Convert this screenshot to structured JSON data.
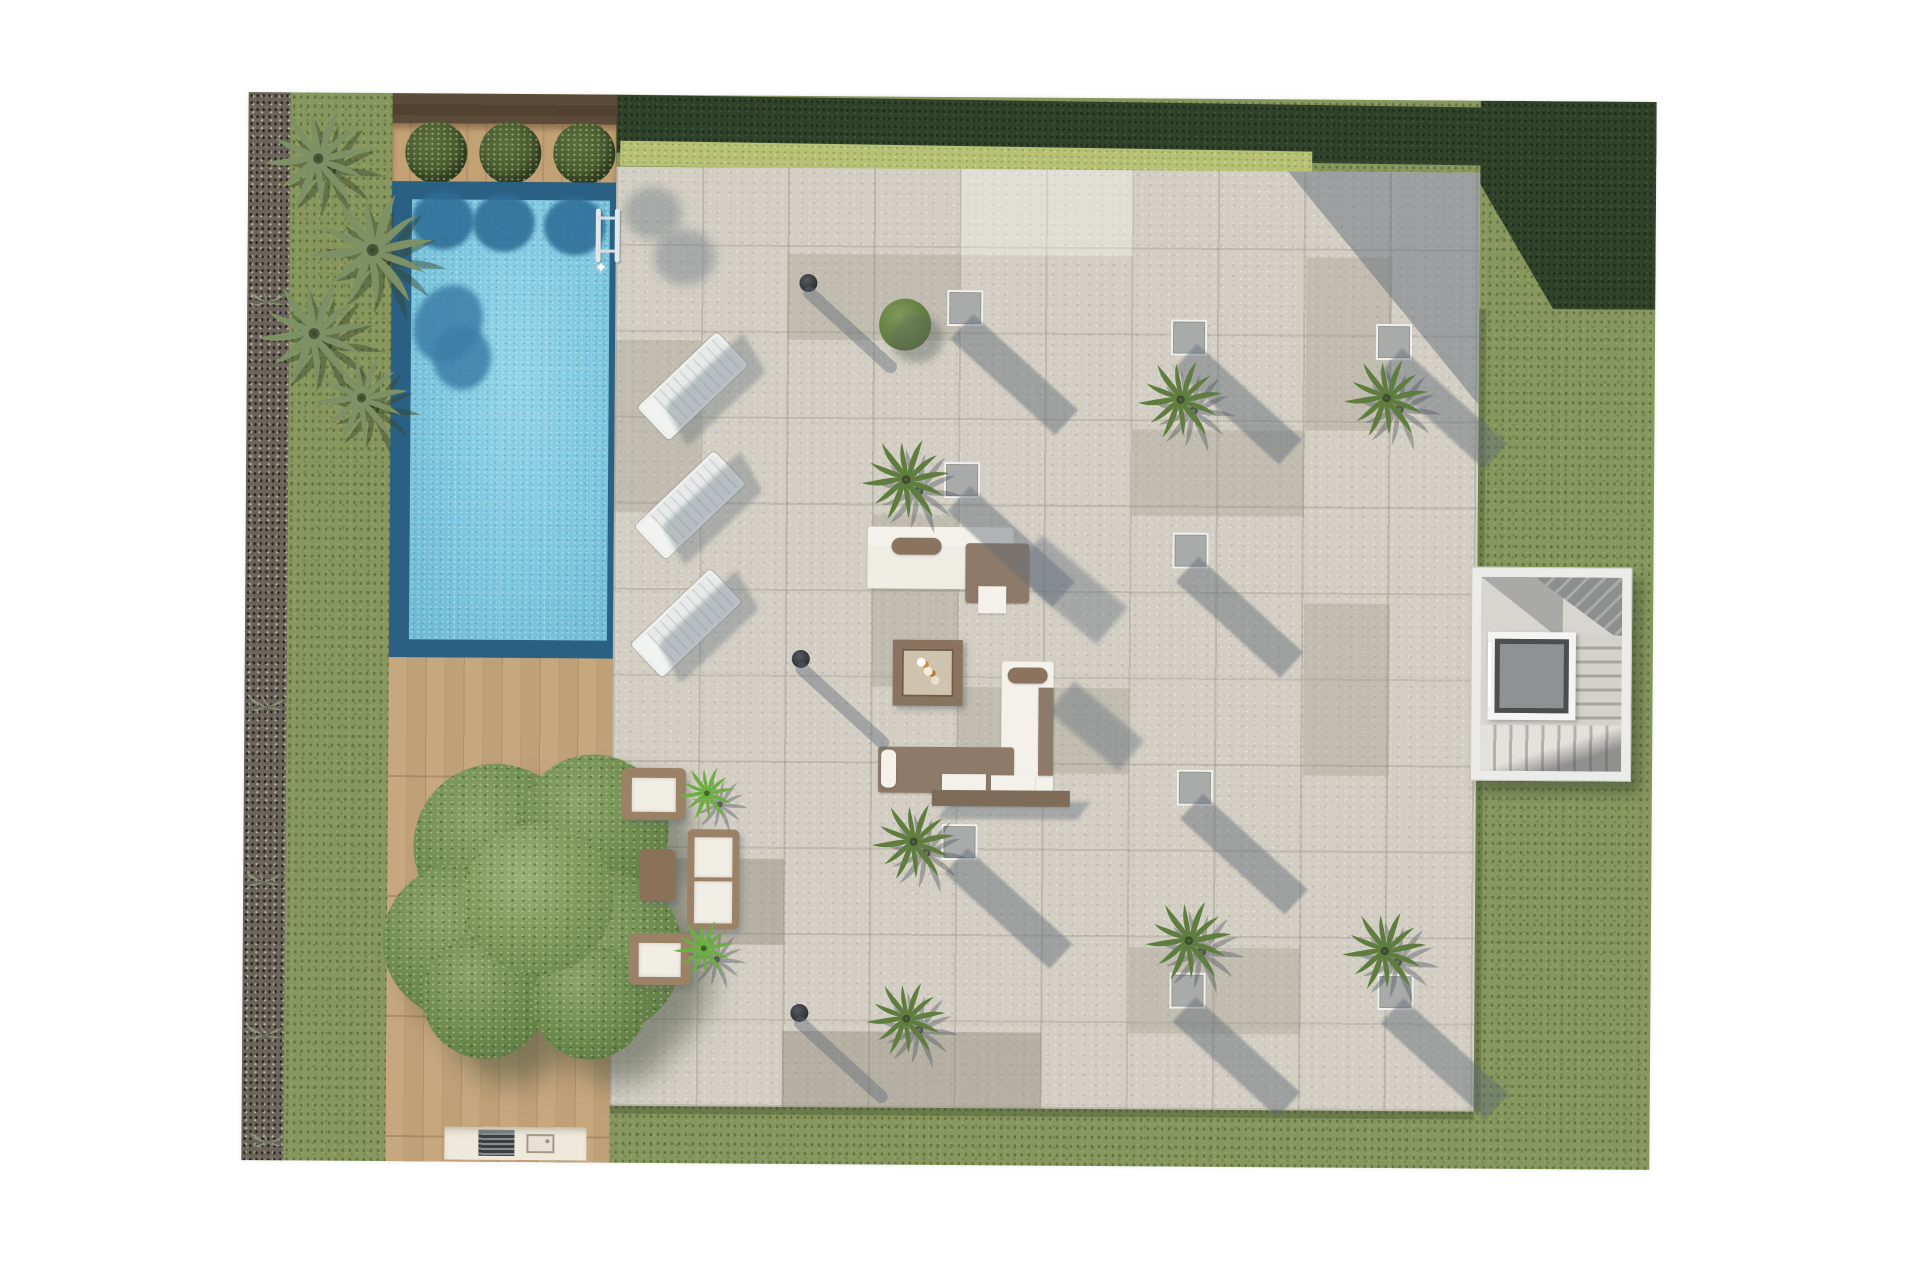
{
  "meta": {
    "title": "Villa roof-garden / pool terrace – top-down architectural render",
    "type": "architectural-site-plan",
    "visible_text": []
  },
  "palette": {
    "background": "#ffffff",
    "grass": "#87975e",
    "hedge_dark": "#31422b",
    "grass_light": "#b6c175",
    "gravel": "#6b655c",
    "pool_border": "#2a6084",
    "pool_water": "#7cc6de",
    "deck_dark_wood": "#5d4b3a",
    "deck_light_wood": "#c2a37b",
    "terrace_tile": "#d2cec3",
    "planter_gray": "#a9abaa",
    "furniture_white": "#f3f1ea",
    "furniture_brown": "#8a7460",
    "tree_green": "#6c8a4c",
    "palm_green": "#5f7d3f",
    "stairs_gray": "#8f9192",
    "shadow": "rgba(100,110,122,0.45)"
  },
  "scene": {
    "areas": [
      "lawn garden",
      "clipped dark hedge",
      "gravel border with grasses",
      "swimming pool with mosaic water",
      "dark timber pool-head deck with 3 round bushes",
      "light timber deck with large tree",
      "stone tile terrace",
      "outdoor kitchen / bbq counter",
      "stair core with lift",
      "wicker lounge set",
      "white-and-brown lounge set",
      "sun loungers",
      "planter cubes with palms",
      "bollard lights"
    ],
    "counts": {
      "sun_loungers": 3,
      "planter_cubes": 9,
      "bollard_lights": 3,
      "deck_bushes": 3,
      "terrace_palms": 7,
      "corner_palm_cluster": 4,
      "agave_plants": 2,
      "grass_tufts": 5,
      "round_bush": 1
    },
    "spawn": [
      {
        "template": "cube",
        "items": [
          [
            700,
            193
          ],
          [
            924,
            221
          ],
          [
            1129,
            224
          ],
          [
            698,
            365
          ],
          [
            927,
            434
          ],
          [
            933,
            671
          ],
          [
            698,
            727
          ],
          [
            927,
            874
          ],
          [
            1135,
            874
          ]
        ]
      },
      {
        "template": "bollard",
        "items": [
          [
            552,
            178
          ],
          [
            547,
            554
          ],
          [
            548,
            908
          ]
        ]
      },
      {
        "template": "lounger",
        "items": [
          [
            391,
            268
          ],
          [
            389,
            387
          ],
          [
            386,
            505
          ]
        ]
      },
      {
        "template": "bush",
        "items": [
          [
            632,
            202
          ]
        ]
      },
      {
        "template": "palm",
        "items": [
          [
            612,
            335,
            96
          ],
          [
            888,
            255,
            92
          ],
          [
            1094,
            252,
            92
          ],
          [
            625,
            700,
            90
          ],
          [
            899,
            795,
            94
          ],
          [
            1096,
            805,
            92
          ],
          [
            621,
            879,
            86
          ],
          [
            12,
            8,
            116,
            "dry"
          ],
          [
            58,
            90,
            134,
            "dry"
          ],
          [
            6,
            180,
            122,
            "dry"
          ],
          [
            64,
            254,
            102,
            "dry"
          ],
          [
            432,
            667,
            62,
            "bright"
          ],
          [
            428,
            820,
            66,
            "bright"
          ]
        ]
      },
      {
        "template": "tuft",
        "items": [
          [
            0,
            196
          ],
          [
            2,
            601
          ],
          [
            0,
            776
          ],
          [
            2,
            929
          ],
          [
            6,
            1037
          ]
        ]
      }
    ]
  }
}
